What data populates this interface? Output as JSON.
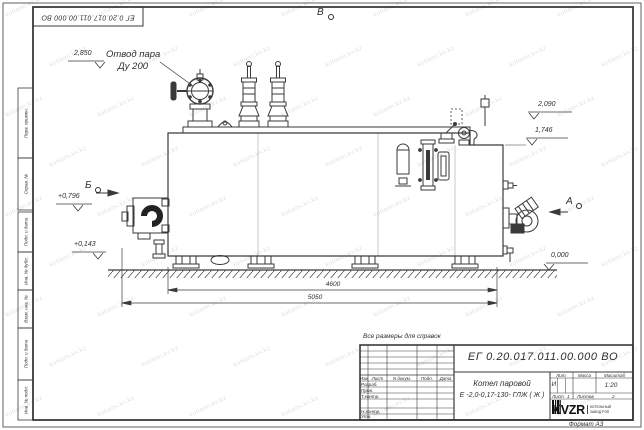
{
  "page": {
    "format_label": "Формат А3",
    "watermark_text": "kotlami.kv.kz"
  },
  "frame": {
    "top_stamp_number": "ЕГ 0.20.017.011.00.000  ВО",
    "side_stamps": [
      "Перв. примен.",
      "Справ. №",
      "Подп. и дата",
      "Инв. № дубл.",
      "Взам. инв. №",
      "Подп. и дата",
      "Инв. № подл."
    ]
  },
  "views": {
    "top": "В",
    "left": "Б",
    "right": "А"
  },
  "callouts": {
    "steam_line1": "Отвод пара",
    "steam_line2": "Ду 200",
    "reference_note": "Все размеры для справок"
  },
  "elevations": {
    "steam_outlet": "2,850",
    "fittings_top": "2,090",
    "shell_top": "1,746",
    "burner_axis": "+0,796",
    "drain": "+0,143",
    "ground": "0,000"
  },
  "dimensions": {
    "shell_length": "4600",
    "overall_length": "5050"
  },
  "title_block": {
    "doc_number": "ЕГ 0.20.017.011.00.000  ВО",
    "product_line1": "Котел паровой",
    "product_line2": "Е -2,0-0,17-130- ГЛЖ ( Ж )",
    "rev_cols": [
      "Изм",
      "Лист",
      "N докум.",
      "Подп.",
      "Дата"
    ],
    "sig_rows": [
      "Разраб.",
      "Пров.",
      "Т.контр.",
      "Н.контр.",
      "Утв."
    ],
    "lit_label": "Лит.",
    "lit_value": "И",
    "mass_label": "Масса",
    "mass_value": "",
    "scale_label": "Масштаб",
    "scale_value": "1:20",
    "sheet_label": "Лист",
    "sheet_value": "1",
    "sheets_label": "Листов",
    "sheets_value": "2",
    "logo_text": "KVZR",
    "company_line1": "КОТЕЛЬНЫЙ",
    "company_line2": "ЗАВОД РЭП"
  }
}
